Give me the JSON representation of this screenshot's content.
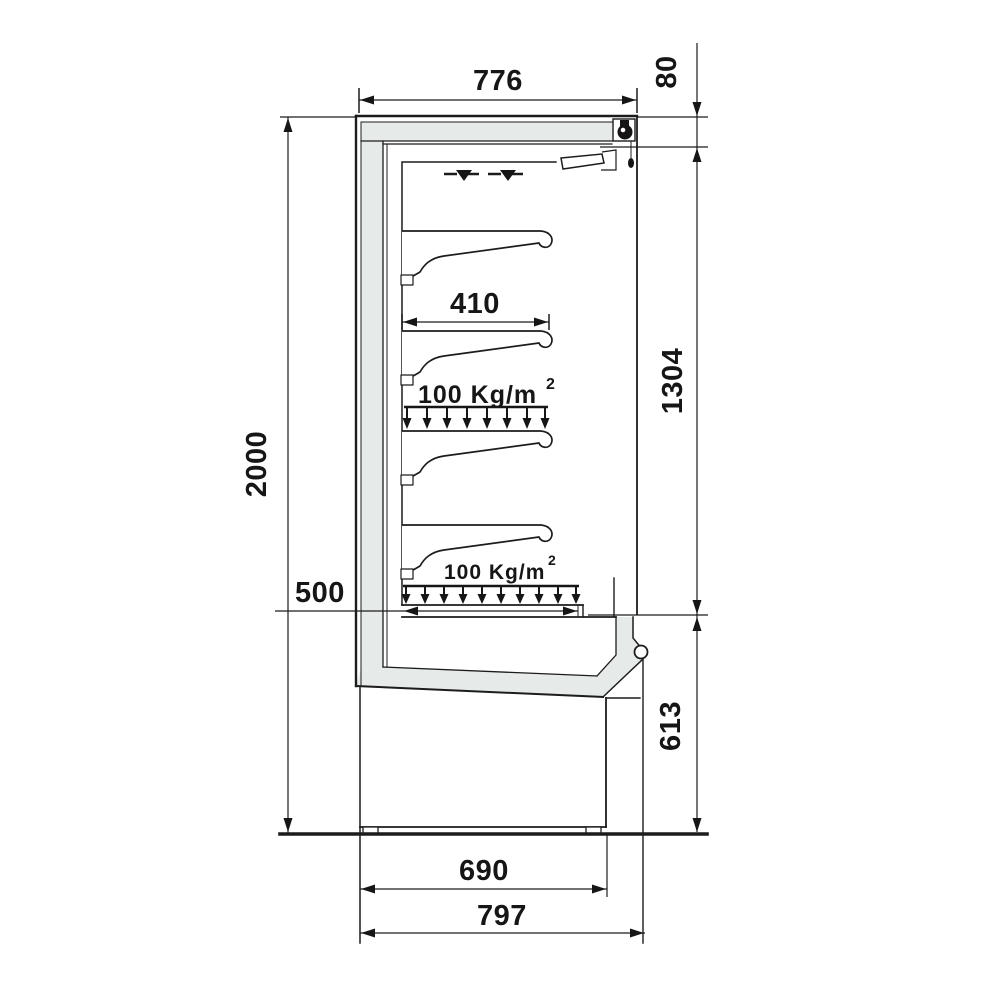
{
  "drawing": {
    "type": "technical-dimension-drawing",
    "units": "mm",
    "dimensions": {
      "top_width": "776",
      "canopy_height": "80",
      "total_height": "2000",
      "display_opening_height": "1304",
      "shelf_depth": "410",
      "bottom_deck_depth": "500",
      "base_section_height": "613",
      "base_depth": "690",
      "overall_depth": "797"
    },
    "labels": {
      "shelf_load": "100 Kg/m",
      "shelf_load_exp": "2"
    },
    "colors": {
      "line": "#1c1c1c",
      "insulation_fill": "#e6eae9",
      "background": "#ffffff"
    }
  }
}
